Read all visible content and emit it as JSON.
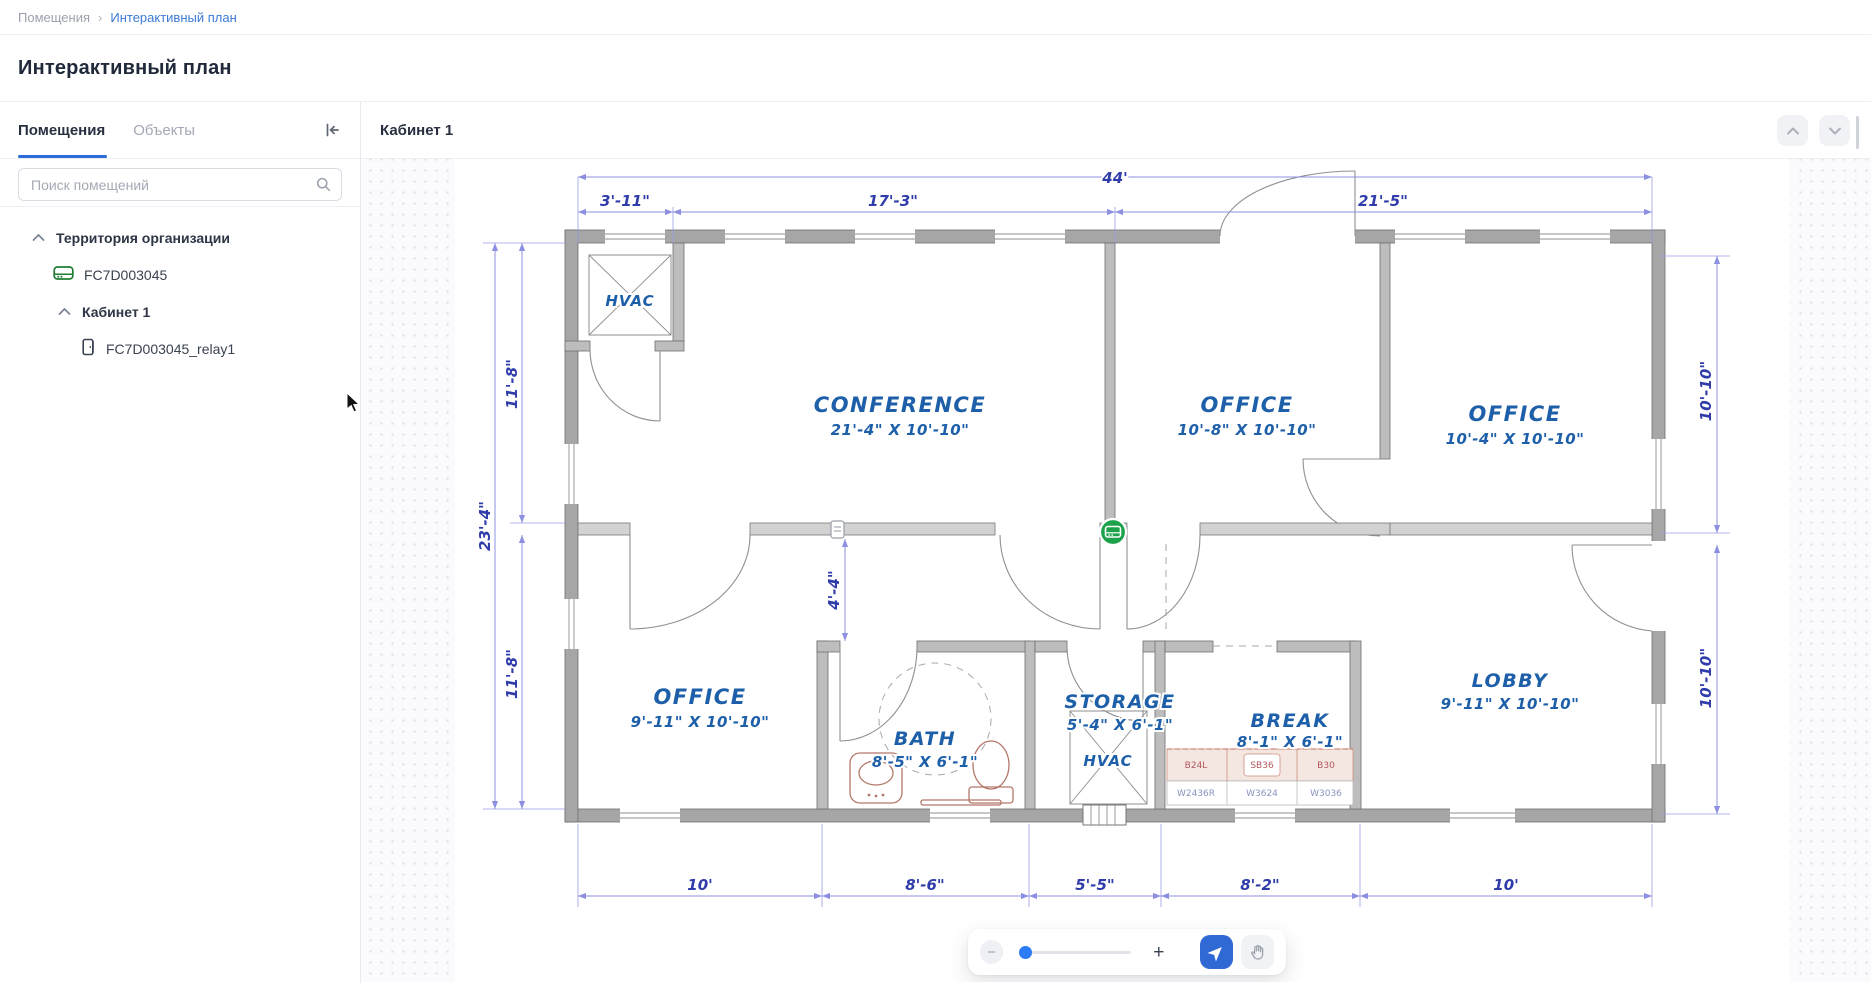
{
  "breadcrumb": {
    "root": "Помещения",
    "separator": "›",
    "current": "Интерактивный план"
  },
  "page": {
    "title": "Интерактивный план"
  },
  "sidebar": {
    "tabs": {
      "rooms": "Помещения",
      "objects": "Объекты"
    },
    "search": {
      "placeholder": "Поиск помещений"
    },
    "tree": {
      "territory": "Территория организации",
      "device": "FC7D003045",
      "room": "Кабинет 1",
      "relay": "FC7D003045_relay1"
    }
  },
  "main": {
    "header": {
      "title": "Кабинет 1"
    }
  },
  "toolbar": {
    "zoom_out": "−",
    "zoom_in": "+"
  },
  "floor_plan": {
    "dims": {
      "overall_top": "44'",
      "top": [
        "3'-11\"",
        "17'-3\"",
        "21'-5\""
      ],
      "left_overall": "23'-4\"",
      "left_upper": "11'-8\"",
      "left_lower": "11'-8\"",
      "corridor": "4'-4\"",
      "right_upper": "10'-10\"",
      "right_lower": "10'-10\"",
      "bottom": [
        "10'",
        "8'-6\"",
        "5'-5\"",
        "8'-2\"",
        "10'"
      ]
    },
    "rooms": {
      "hvac_closet": {
        "name": "HVAC"
      },
      "conference": {
        "name": "CONFERENCE",
        "size": "21'-4\" X 10'-10\""
      },
      "office_mid": {
        "name": "OFFICE",
        "size": "10'-8\" X 10'-10\""
      },
      "office_right": {
        "name": "OFFICE",
        "size": "10'-4\" X 10'-10\""
      },
      "office_bottom": {
        "name": "OFFICE",
        "size": "9'-11\" X 10'-10\""
      },
      "bath": {
        "name": "BATH",
        "size": "8'-5\" X 6'-1\""
      },
      "storage": {
        "name": "STORAGE",
        "size": "5'-4\" X 6'-1\""
      },
      "storage_hvac": {
        "name": "HVAC"
      },
      "break_room": {
        "name": "BREAK",
        "size": "8'-1\" X 6'-1\""
      },
      "lobby": {
        "name": "LOBBY",
        "size": "9'-11\" X 10'-10\""
      }
    },
    "cabinets": {
      "top": [
        "B24L",
        "SB36",
        "B30"
      ],
      "bottom": [
        "W2436R",
        "W3624",
        "W3036"
      ]
    }
  },
  "colors": {
    "accent": "#2e6bd6",
    "plan_text": "#1e5fa9",
    "dim_text": "#2f3caa",
    "marker_green": "#1ba24a",
    "device_green": "#1e7d32"
  }
}
